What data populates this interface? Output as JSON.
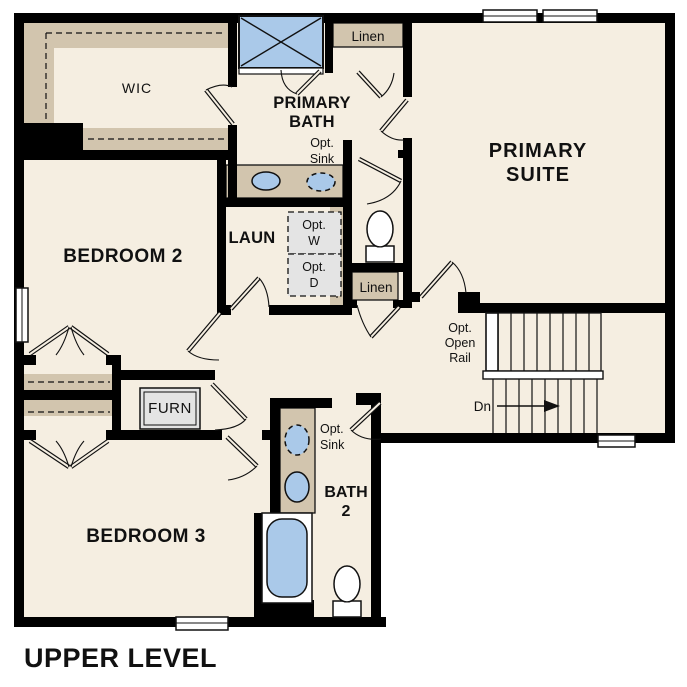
{
  "colors": {
    "floor": "#f5eee1",
    "wall": "#000000",
    "shelf_tan": "#d2c5ae",
    "fixture_blue": "#aac9e9",
    "appliance_gray": "#e4e4e4",
    "text": "#111111"
  },
  "plan": {
    "title": "UPPER LEVEL",
    "rooms": {
      "wic": "WIC",
      "primary_bath": [
        "PRIMARY",
        "BATH"
      ],
      "primary_suite": [
        "PRIMARY",
        "SUITE"
      ],
      "bedroom2": "BEDROOM 2",
      "bedroom3": "BEDROOM 3",
      "laundry": "LAUN",
      "bath2": [
        "BATH",
        "2"
      ]
    },
    "closets": {
      "linen_upper": "Linen",
      "linen_hall": "Linen"
    },
    "annotations": {
      "opt_sink_bath1": [
        "Opt.",
        "Sink"
      ],
      "opt_sink_bath2": [
        "Opt.",
        "Sink"
      ],
      "opt_washer": [
        "Opt.",
        "W"
      ],
      "opt_dryer": [
        "Opt.",
        "D"
      ],
      "opt_open_rail": [
        "Opt.",
        "Open",
        "Rail"
      ],
      "stairs_down": "Dn",
      "furnace": "FURN"
    },
    "fixtures": [
      "shower-icon",
      "tub-icon",
      "toilet-icon",
      "sink-icon",
      "washer-icon",
      "dryer-icon",
      "stairs-icon",
      "window-icon",
      "door-icon"
    ]
  }
}
